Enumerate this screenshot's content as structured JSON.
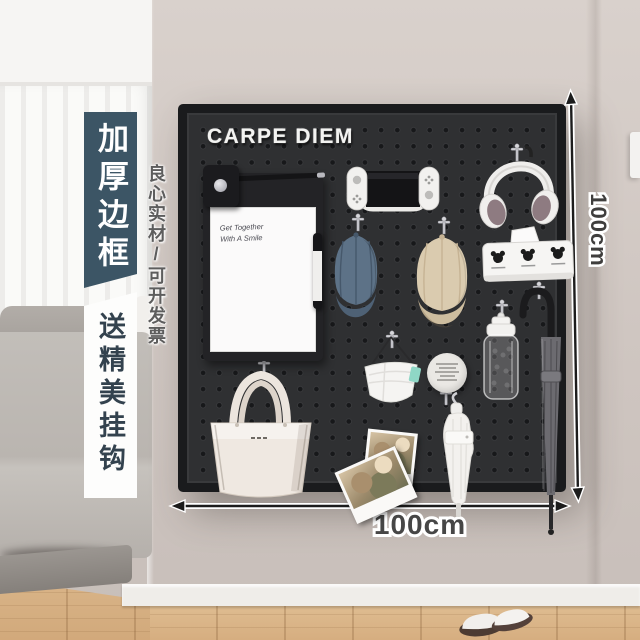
{
  "board": {
    "title": "CARPE DIEM"
  },
  "dimensions": {
    "height": "100cm",
    "width": "100cm"
  },
  "banners": {
    "primary": "加厚边框",
    "secondary": "送精美挂钩",
    "side_note": "良心实材/可开发票"
  },
  "whiteboard": {
    "line1": "Get Together",
    "line2": "With A Smile"
  },
  "polaroid": {
    "caption": "Family"
  },
  "objects": [
    "clipboard-whiteboard",
    "marker-pen",
    "game-console",
    "headphones",
    "mickey-tissue-box",
    "denim-cap",
    "beige-cap",
    "face-mask",
    "note-disc",
    "water-bottle",
    "gray-umbrella",
    "white-umbrella",
    "handbag",
    "polaroid-photos",
    "slippers",
    "peg-hooks"
  ],
  "colors": {
    "banner_dark": "#3c5565",
    "board": "#2f3032",
    "wall": "#cfc6c1",
    "denim_cap": "#5d7287",
    "beige_cap": "#dacbaf",
    "teal_tag": "#8fd7c6",
    "wood_floor": "#d9b68b"
  }
}
